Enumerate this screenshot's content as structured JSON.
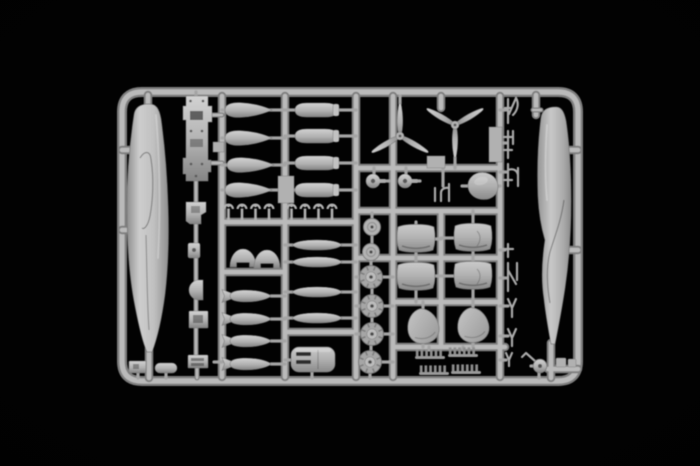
{
  "meta": {
    "description": "Photograph of a light-gray injection-molded plastic model kit sprue (parts frame) of a twin-engine aircraft kit, centered on a pure black background",
    "alt": "Model kit sprue with aircraft parts"
  },
  "colors": {
    "background": "#020202",
    "plastic_base": "#b1b1b1",
    "plastic_highlight": "#d2d2d2",
    "plastic_shadow": "#848484",
    "runner_core": "#bababa",
    "runner_edge": "#7f7f7f",
    "detail_dark": "#3e3e3e"
  },
  "parts": [
    {
      "name": "fuselage-half-left",
      "count": 1
    },
    {
      "name": "fuselage-half-right",
      "count": 1
    },
    {
      "name": "three-blade-propeller",
      "count": 2
    },
    {
      "name": "cockpit-floor-panel",
      "count": 1
    },
    {
      "name": "drop-tank",
      "count": 4
    },
    {
      "name": "fuel-tank",
      "count": 4
    },
    {
      "name": "finned-bomb",
      "count": 4
    },
    {
      "name": "slim-bomb",
      "count": 4
    },
    {
      "name": "treaded-main-wheel",
      "count": 4
    },
    {
      "name": "wheel-disc",
      "count": 2
    },
    {
      "name": "spinner-hub",
      "count": 2
    },
    {
      "name": "engine-cowling-half",
      "count": 4
    },
    {
      "name": "oval-cowling-panel",
      "count": 2
    },
    {
      "name": "exhaust-stack-row",
      "count": 4
    },
    {
      "name": "slotted-canopy-cover",
      "count": 1
    },
    {
      "name": "small-pin-part",
      "count": 8
    },
    {
      "name": "strut-and-antenna-part",
      "count": 8
    },
    {
      "name": "tail-wheel",
      "count": 1
    }
  ]
}
